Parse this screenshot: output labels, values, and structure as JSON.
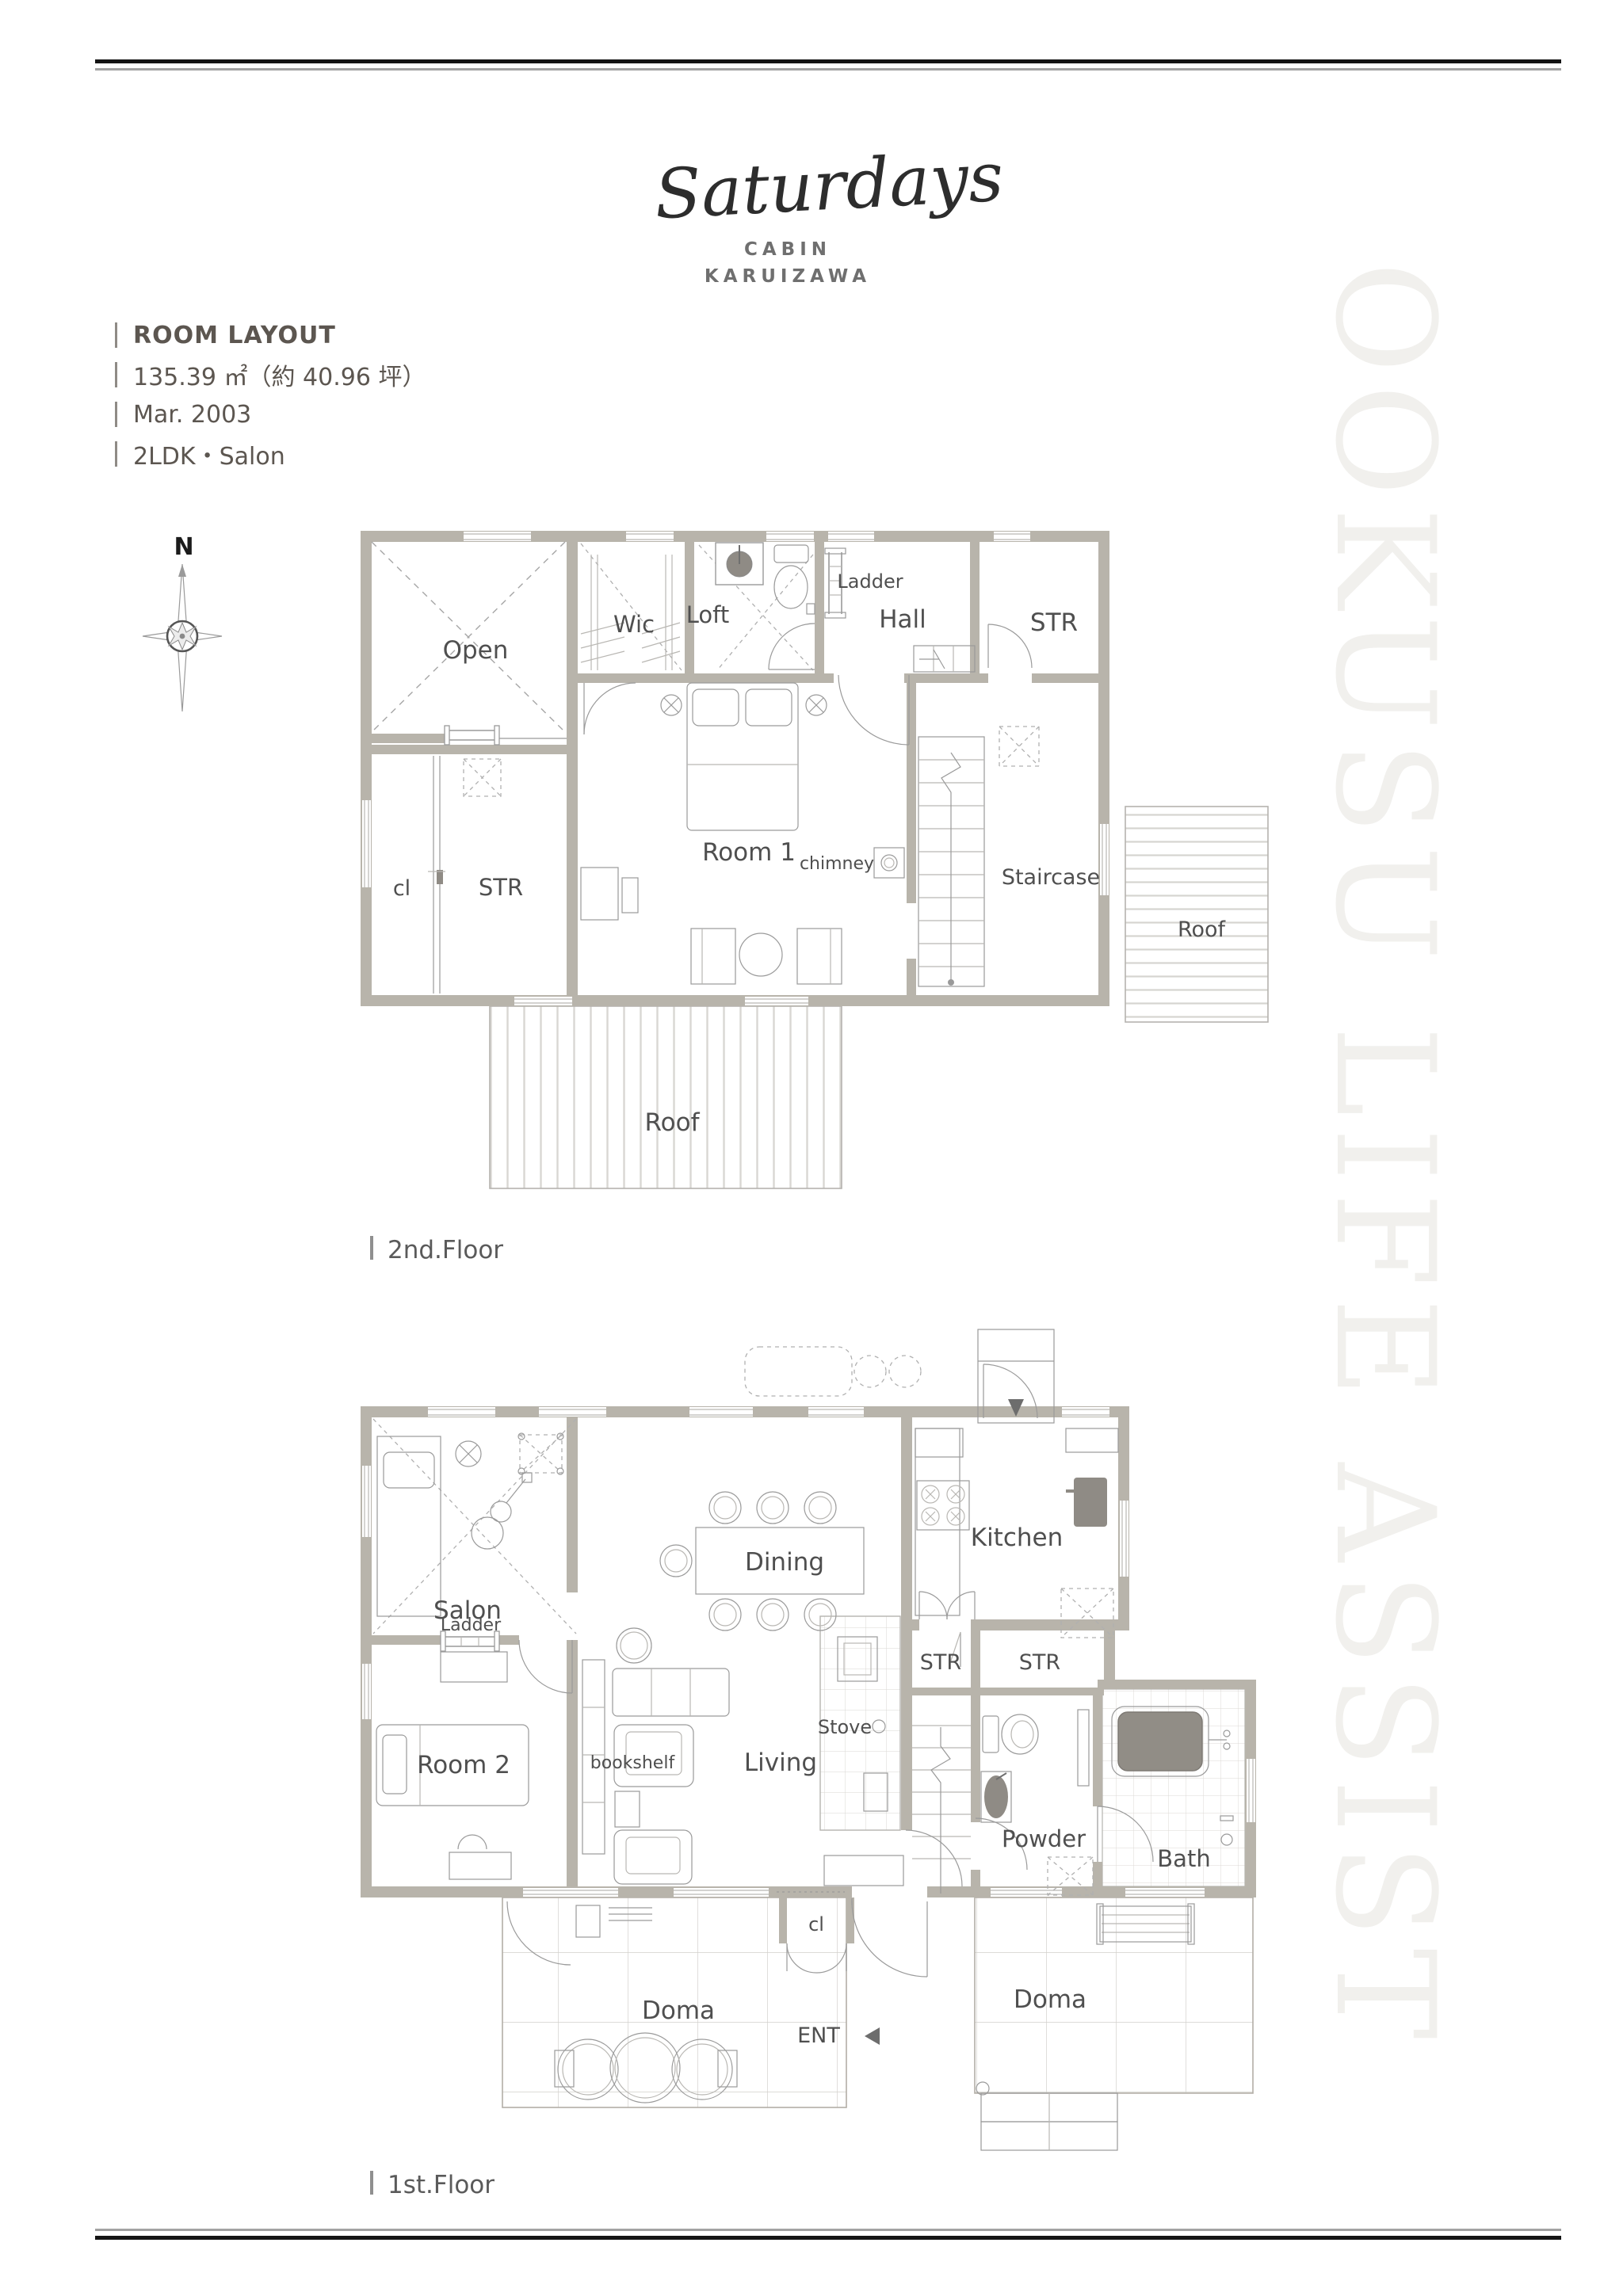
{
  "header": {
    "logo": "Saturdays",
    "line1": "CABIN",
    "line2": "KARUIZAWA"
  },
  "info": {
    "title": "ROOM LAYOUT",
    "area": "135.39 ㎡（約 40.96 坪）",
    "built": "Mar. 2003",
    "layout": "2LDK・Salon"
  },
  "compass": {
    "north": "N"
  },
  "watermark": {
    "text": "OOKUSU LIFE ASSIST"
  },
  "floor2": {
    "caption": "2nd.Floor",
    "labels": {
      "open": "Open",
      "wic": "Wic",
      "loft": "Loft",
      "ladder": "Ladder",
      "hall": "Hall",
      "str_top": "STR",
      "cl": "cl",
      "str_left": "STR",
      "room1": "Room 1",
      "chimney": "chimney",
      "staircase": "Staircase",
      "roof_right": "Roof",
      "roof_bottom": "Roof"
    }
  },
  "floor1": {
    "caption": "1st.Floor",
    "labels": {
      "salon": "Salon",
      "ladder": "Ladder",
      "dining": "Dining",
      "kitchen": "Kitchen",
      "room2": "Room 2",
      "bookshelf": "bookshelf",
      "living": "Living",
      "stove": "Stove",
      "str_a": "STR",
      "str_b": "STR",
      "powder": "Powder",
      "bath": "Bath",
      "cl": "cl",
      "doma_left": "Doma",
      "ent": "ENT",
      "doma_right": "Doma"
    }
  },
  "colors": {
    "wall": "#b8b4ab",
    "thin_line": "#9a9a9a",
    "label_text": "#4f4f4f",
    "fixture_dark": "#8f8b85",
    "watermark": "#f1f0ed",
    "rule_black": "#141414",
    "rule_gray": "#a2a2a2"
  }
}
